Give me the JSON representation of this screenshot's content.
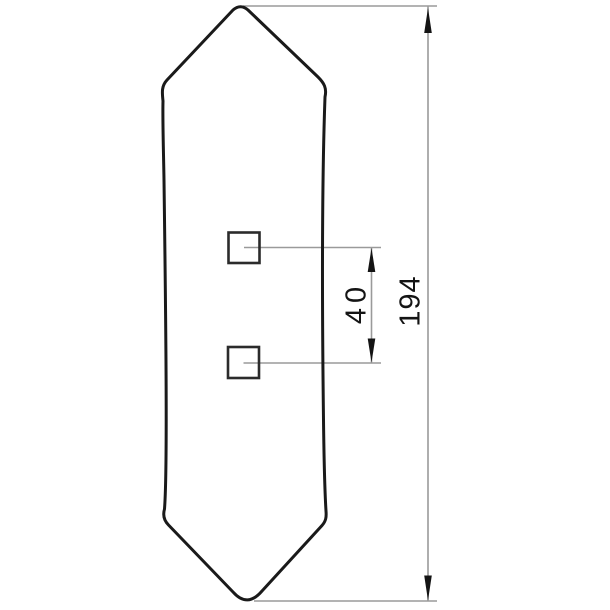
{
  "drawing": {
    "labels": {
      "hole_spacing": "40",
      "overall_length": "194"
    },
    "colors": {
      "outline": "#1a1a1a",
      "hole_stroke": "#2b2b2b",
      "thin_line": "#9a9a9a",
      "arrow": "#141414",
      "text": "#141414",
      "background": "#ffffff"
    }
  }
}
